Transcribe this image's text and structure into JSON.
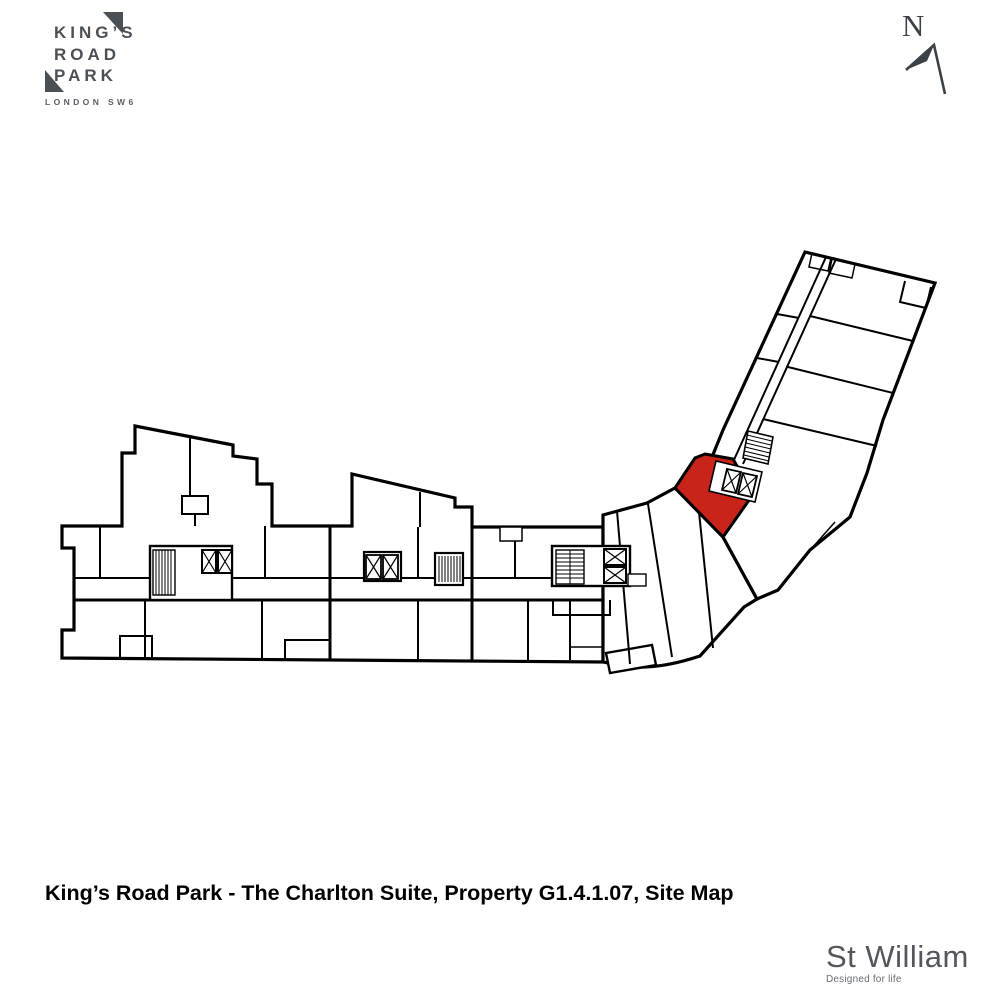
{
  "brand_logo": {
    "lines": [
      "KING’S",
      "ROAD",
      "PARK"
    ],
    "subtitle": "LONDON SW6",
    "color": "#4b5055"
  },
  "compass": {
    "label": "N",
    "color": "#3c4147"
  },
  "site_map": {
    "highlight_color": "#C9241A",
    "line_color": "#000000",
    "background": "#ffffff"
  },
  "caption": {
    "text": "King’s Road Park - The Charlton Suite, Property G1.4.1.07, Site Map"
  },
  "developer_logo": {
    "name": "St William",
    "tagline": "Designed for life",
    "color": "#53565a"
  }
}
